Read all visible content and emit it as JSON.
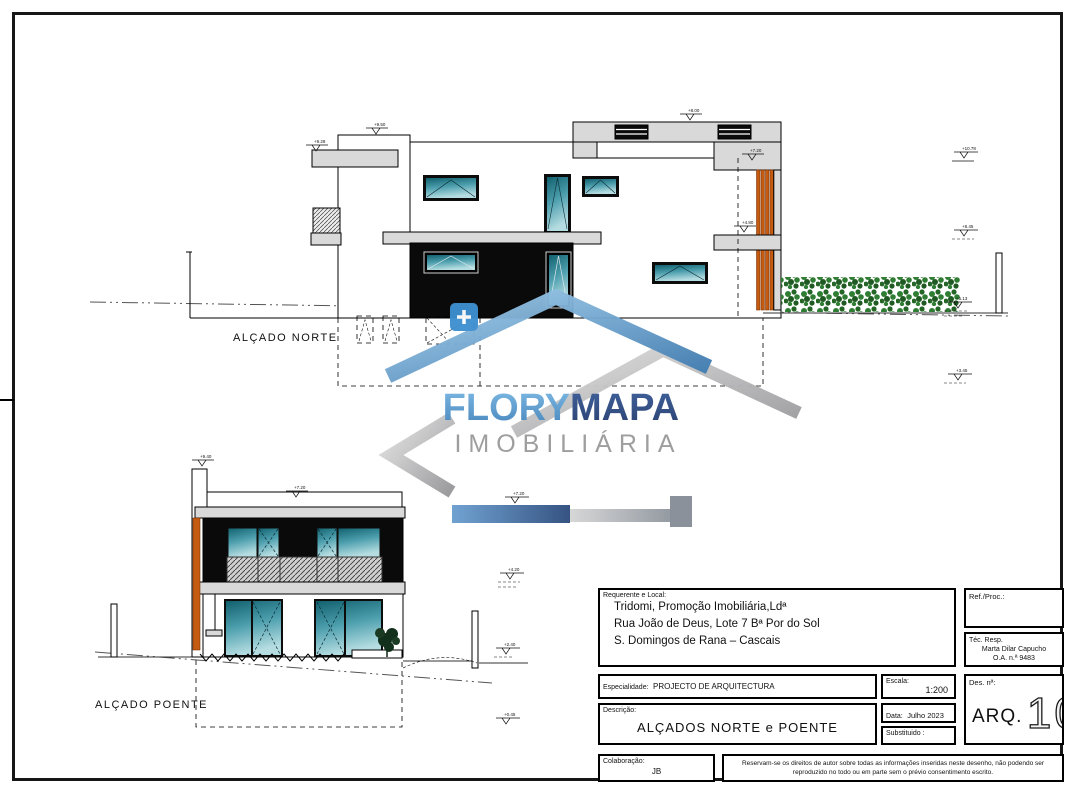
{
  "sheet": {
    "background": "#ffffff",
    "frame_color": "#161616"
  },
  "watermark": {
    "brand_primary": "FLORY",
    "brand_secondary": "MAPA",
    "subtitle": "IMOBILIÁRIA",
    "colors": {
      "primary_blue": "#4c8ec4",
      "navy": "#2c4f8c",
      "silver": "#9b9b9b",
      "slat_orange": "#c55a11"
    }
  },
  "drawing": {
    "north": {
      "label": "ALÇADO NORTE",
      "levels": [
        "+9.50",
        "+9.28",
        "+8.00",
        "+7.20",
        "+4.80"
      ],
      "right_levels": [
        "+10.78",
        "+8.45",
        "+5.13",
        "+3.45"
      ]
    },
    "west": {
      "label": "ALÇADO POENTE",
      "levels": [
        "+9.40",
        "+7.20"
      ],
      "right_levels": [
        "+7.20",
        "+4.20",
        "+2.40",
        "+0.45"
      ]
    }
  },
  "title_block": {
    "requerente_label": "Requerente e Local:",
    "requerente_line1": "Tridomi, Promoção Imobiliária,Ldª",
    "requerente_line2": "Rua João de Deus, Lote 7 Bª Por do Sol",
    "requerente_line3": "S. Domingos de Rana – Cascais",
    "ref_label": "Ref./Proc.:",
    "tec_label": "Téc. Resp.",
    "tec_name": "Marta Dilar Capucho",
    "tec_number": "O.A. n.ª 9483",
    "especialidade_label": "Especialidade:",
    "especialidade_value": "PROJECTO DE ARQUITECTURA",
    "escala_label": "Escala:",
    "escala_value": "1:200",
    "des_label": "Des. nª:",
    "descricao_label": "Descrição:",
    "descricao_value": "ALÇADOS NORTE e POENTE",
    "data_label": "Data:",
    "data_value": "Julho 2023",
    "substituido_label": "Substituido :",
    "drawing_code": "ARQ.",
    "drawing_number": "10",
    "colaboracao_label": "Colaboração:",
    "colaboracao_value": "JB",
    "copyright": "Reservam-se os direitos de autor sobre todas as informações inseridas neste desenho, não podendo ser reproduzido no todo ou em parte sem o prévio consentimento escrito."
  }
}
